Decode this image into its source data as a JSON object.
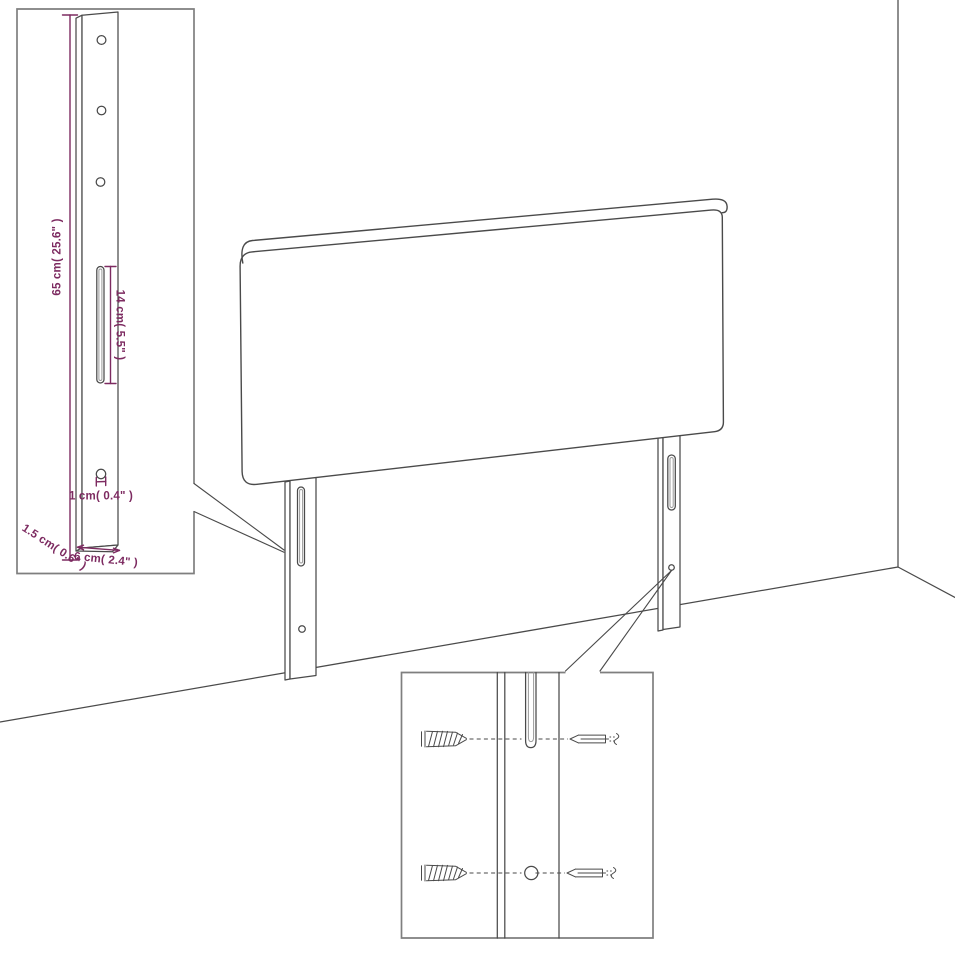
{
  "diagram": {
    "title": "Headboard with legs - mounting dimension diagram",
    "background": "#FFFFFF",
    "accent_color": "#7D2B61",
    "line_color": "#4A4A4A",
    "frame_color": "#7F7F7F",
    "inset_top_left": {
      "labels": {
        "leg_height": "65 cm( 25.6\" )",
        "slot_length": "14 cm( 5.5\" )",
        "hole_size": "1 cm( 0.4\" )",
        "leg_depth": "1.5 cm( 0.6\" )",
        "leg_width": "6 cm( 2.4\" )"
      }
    }
  }
}
